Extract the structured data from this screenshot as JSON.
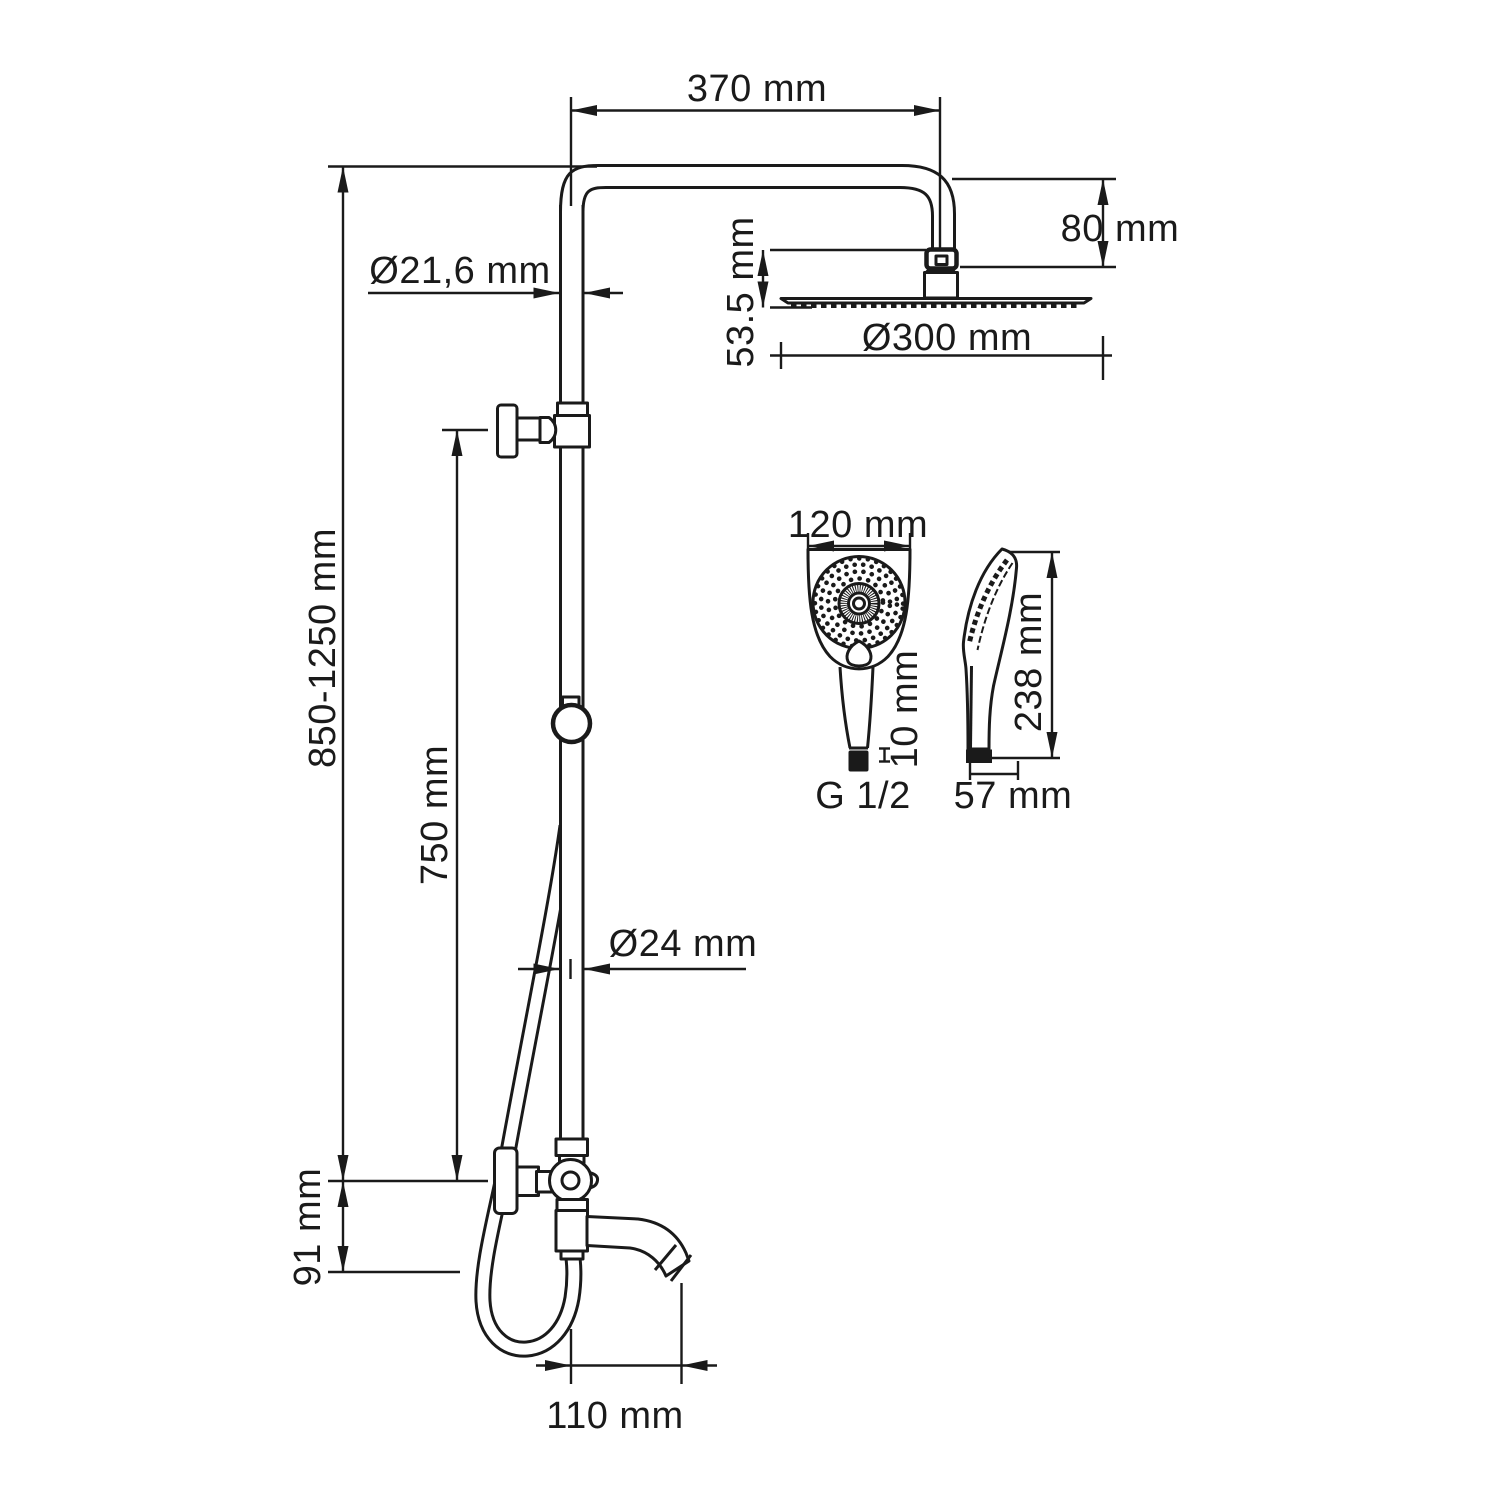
{
  "page": {
    "background": "#ffffff",
    "ink_color": "#1a1a1a",
    "drawing_type": "shower system installation dimensions"
  },
  "labels": {
    "top_arm_width": "370 mm",
    "head_offset_height": "80 mm",
    "upper_pipe_diameter": "Ø21,6 mm",
    "head_thickness": "53.5 mm",
    "head_diameter": "Ø300 mm",
    "column_height_range": "850-1250 mm",
    "slider_height": "750 mm",
    "lower_pipe_diameter": "Ø24 mm",
    "spout_drop": "91 mm",
    "spout_reach": "110 mm",
    "handshower_width": "120 mm",
    "handshower_connector_length": "10 mm",
    "handshower_thread": "G 1/2",
    "handshower_length": "238 mm",
    "handshower_depth": "57 mm"
  }
}
